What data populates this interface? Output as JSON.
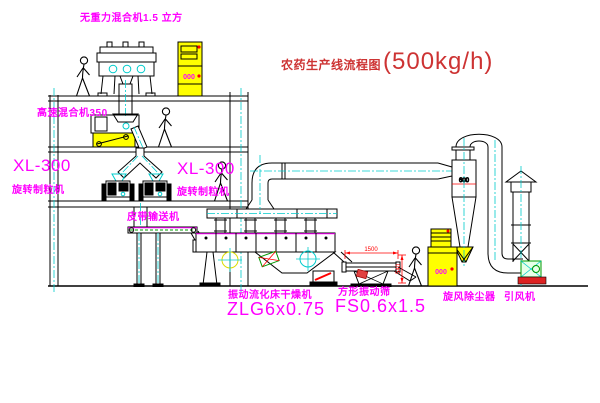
{
  "title": {
    "name": "农药生产线流程图",
    "capacity": "(500kg/h)"
  },
  "equipment_labels": {
    "gravity_mixer": "无重力混合机1.5 立方",
    "high_speed_mixer": "高速混合机350",
    "granulator_left": {
      "model": "XL-300",
      "name": "旋转制粒机"
    },
    "granulator_right": {
      "model": "XL-300",
      "name": "旋转制粒机"
    },
    "belt_conveyor": "皮带输送机",
    "fluid_bed_dryer": {
      "name": "振动流化床干燥机",
      "model": "ZLG6x0.75"
    },
    "vibrating_screen": {
      "name": "方形振动筛",
      "model": "FS0.6x1.5"
    },
    "cyclone": "旋风除尘器",
    "draft_fan": "引风机"
  },
  "dimensions": {
    "cyclone_diameter": "600",
    "screen_length": "1500",
    "screen_height": "540"
  },
  "indicators": {
    "cabinet_top_display": "000",
    "cabinet_right_display": "000"
  },
  "colors": {
    "line": "#000000",
    "centerline": "#00cccc",
    "label": "#ff00ff",
    "title": "#cd3333",
    "dimension": "#ff0000",
    "cabinet": "#ffff00"
  }
}
